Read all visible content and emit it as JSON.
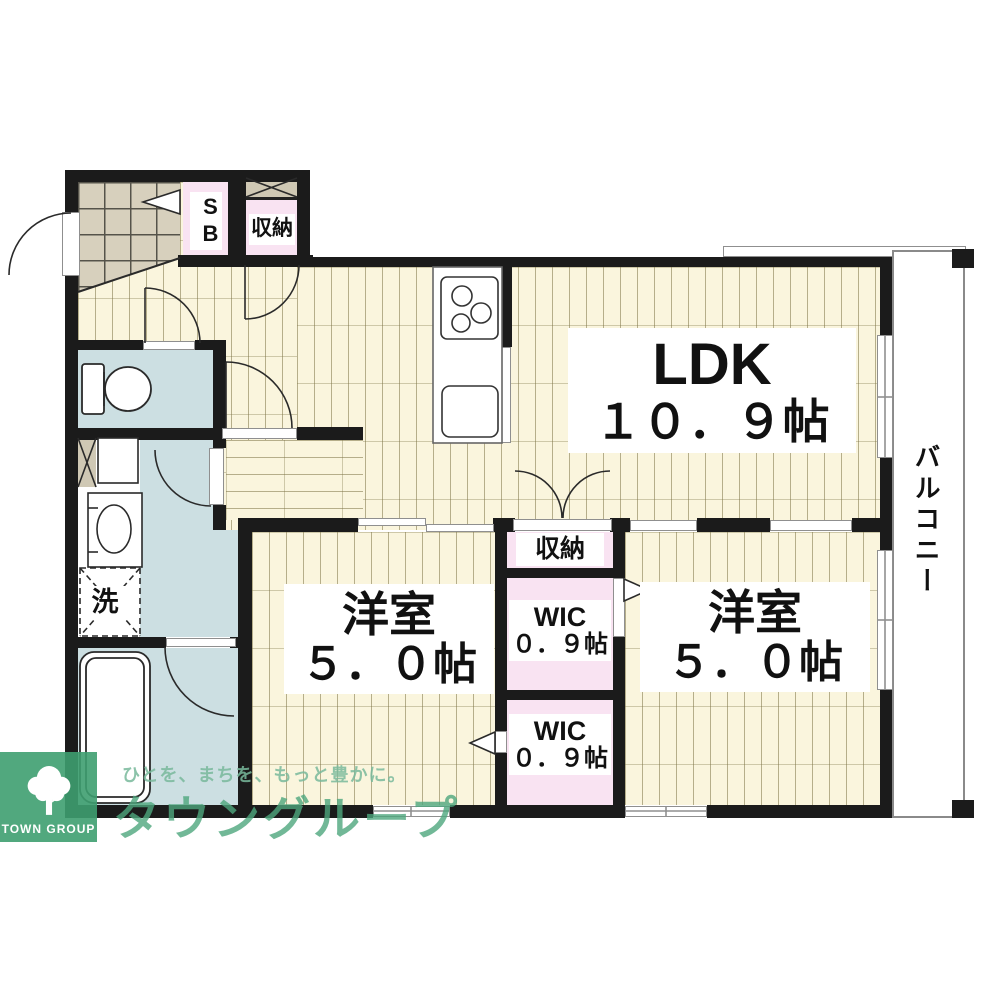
{
  "plan": {
    "rooms": {
      "ldk": {
        "name": "LDK",
        "size": "１０．９帖"
      },
      "bedroom_left": {
        "name": "洋室",
        "size": "５．０帖"
      },
      "bedroom_right": {
        "name": "洋室",
        "size": "５．０帖"
      },
      "wic_upper": {
        "name": "WIC",
        "size": "０．９帖"
      },
      "wic_lower": {
        "name": "WIC",
        "size": "０．９帖"
      },
      "storage_hall": {
        "label": "収納"
      },
      "storage_ldk": {
        "label": "収納"
      },
      "shoe_box": {
        "label": "SB"
      },
      "laundry": {
        "label": "洗"
      },
      "balcony": {
        "label": "バルコニー"
      }
    },
    "colors": {
      "wall": "#1b1b1b",
      "wood_floor": "#faf5dd",
      "closet_pink": "#f9e3f2",
      "wet_area_blue": "#ccdfe2",
      "entry_tile": "#d7d0bd"
    }
  },
  "branding": {
    "logo_text": "TOWN GROUP",
    "tagline": "ひとを、まちを、もっと豊かに。",
    "company": "タウングループ",
    "brand_green": "#44a178"
  }
}
